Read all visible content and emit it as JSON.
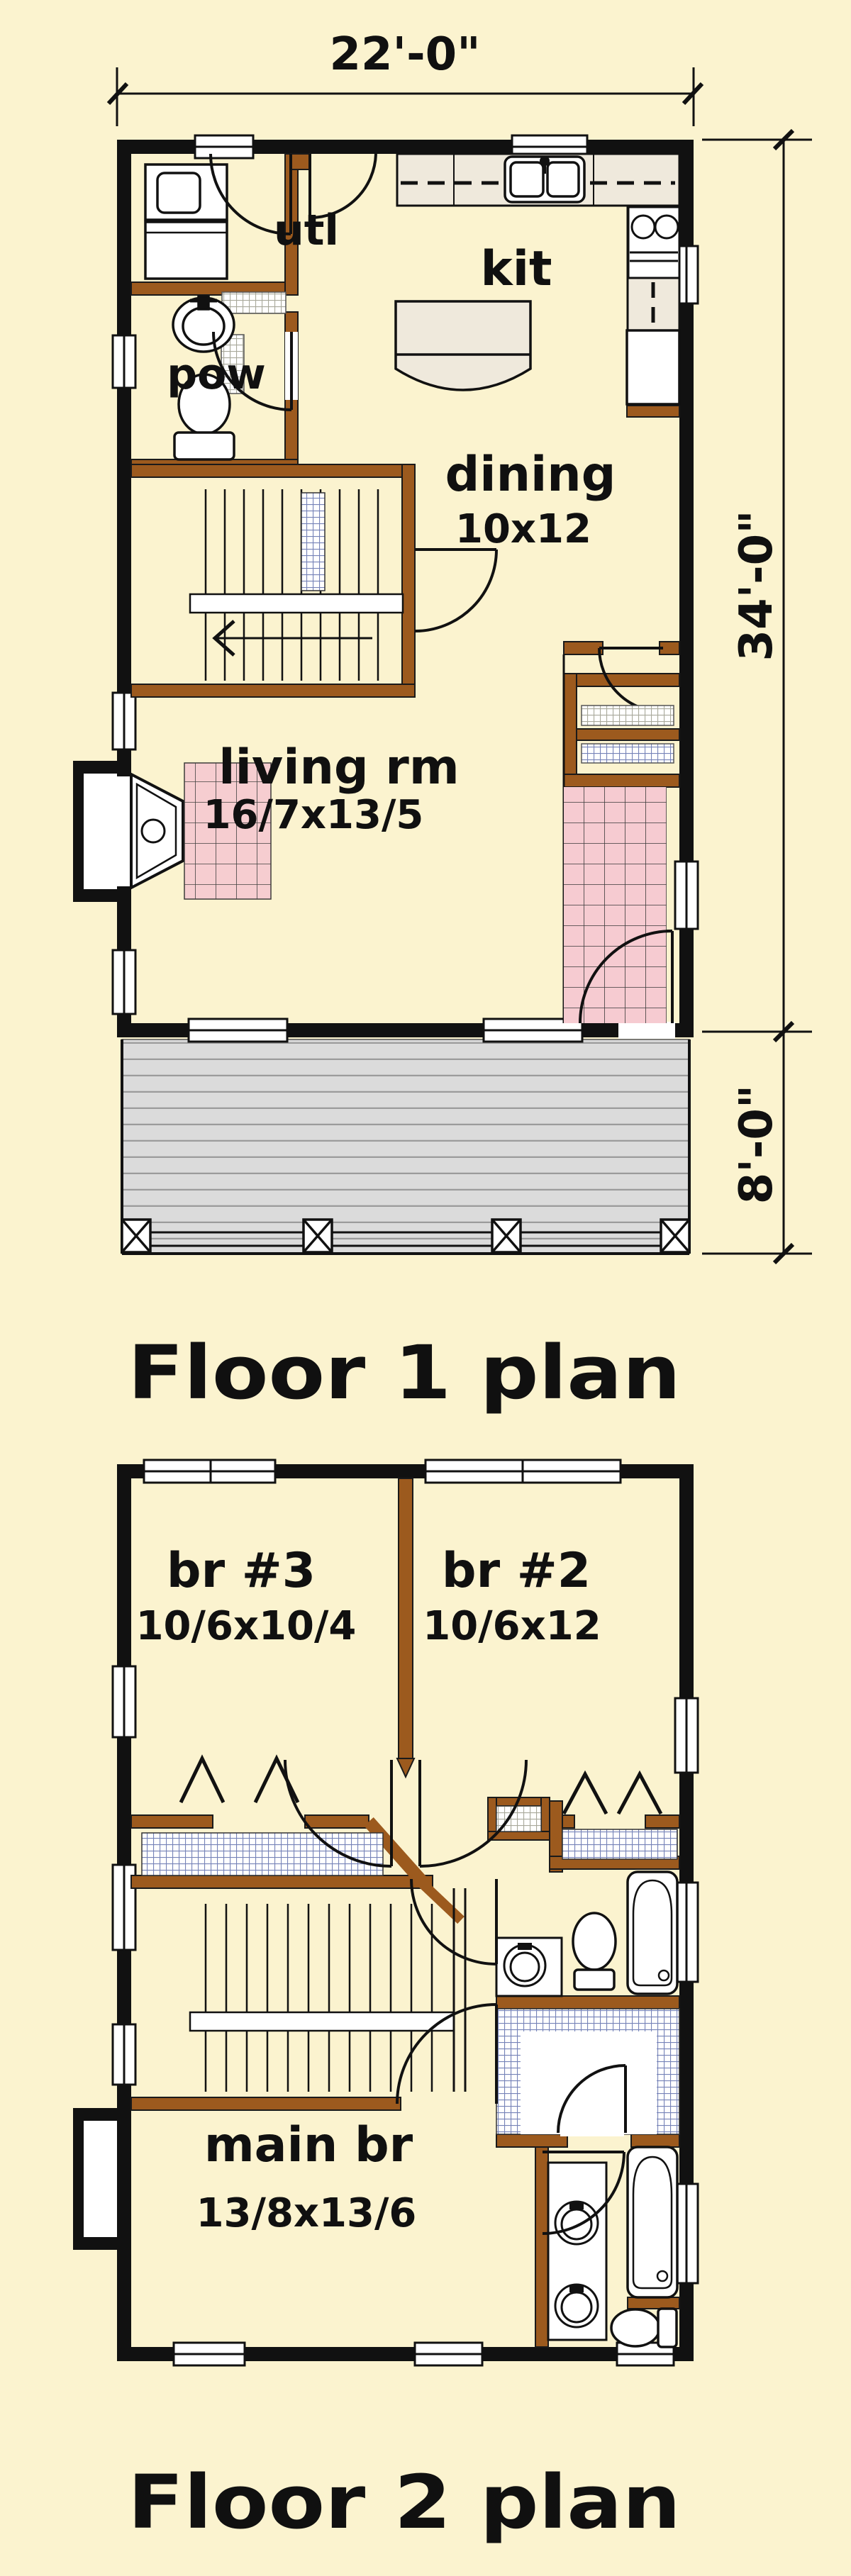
{
  "canvas": {
    "background": "#FBF3CF",
    "exterior_wall_color": "#111111",
    "interior_wall_color": "#9C5A1E",
    "tile_pink": "#F6CBD1",
    "shelf_blue": "#7683B8",
    "shelf_gray": "#A9A99B",
    "deck_gray": "#DBDBDB",
    "counter_beige": "#EFE9DC"
  },
  "titles": {
    "floor1": "Floor 1 plan",
    "floor2": "Floor 2 plan"
  },
  "dimensions": {
    "overall_width": "22'-0\"",
    "main_depth": "34'-0\"",
    "porch_depth": "8'-0\""
  },
  "floor1": {
    "rooms": {
      "utility": {
        "label": "utl"
      },
      "powder": {
        "label": "pow"
      },
      "kitchen": {
        "label": "kit"
      },
      "dining": {
        "label": "dining",
        "size": "10x12"
      },
      "living": {
        "label": "living rm",
        "size": "16/7x13/5"
      }
    }
  },
  "floor2": {
    "rooms": {
      "br3": {
        "label": "br #3",
        "size": "10/6x10/4"
      },
      "br2": {
        "label": "br #2",
        "size": "10/6x12"
      },
      "main": {
        "label": "main br",
        "size": "13/8x13/6"
      }
    }
  },
  "icons": {
    "fixtures": [
      "stairs",
      "washer-dryer",
      "sink",
      "toilet",
      "range",
      "refrigerator",
      "kitchen-island",
      "fireplace",
      "bathtub",
      "vanity-sinks",
      "deck-post",
      "door-swing",
      "window",
      "closet-shelf"
    ]
  }
}
